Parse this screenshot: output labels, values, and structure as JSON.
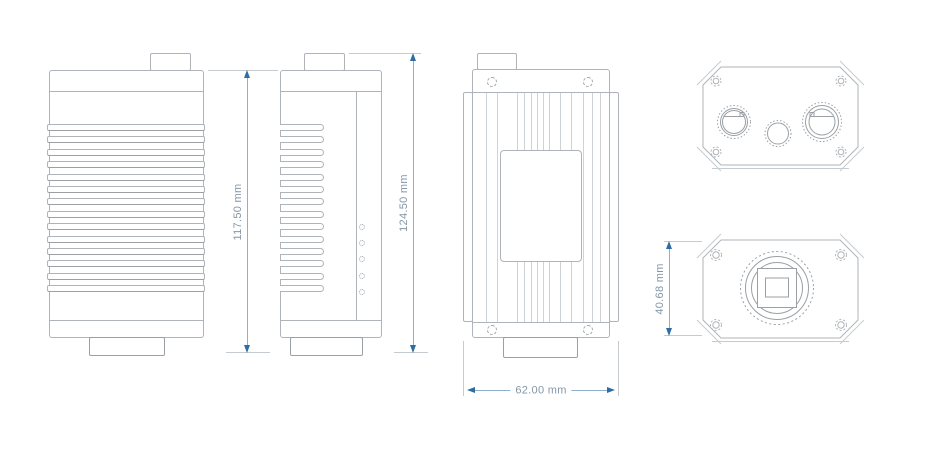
{
  "dimensions": {
    "body_height": "117.50 mm",
    "overall_height": "124.50 mm",
    "body_width": "62.00 mm",
    "face_height": "40.68 mm"
  },
  "colors": {
    "background": "#ffffff",
    "outline": "#aeb4b9",
    "outline_dark": "#9aa0a5",
    "rib": "#ced3d7",
    "dim_line": "#8fafcd",
    "dim_arrow": "#2e6da4",
    "dim_text": "#8496a7",
    "ext_line": "#c6cbcf"
  },
  "geometry": {
    "fin_count": 14,
    "led_count": 5,
    "rib_offsets": [
      14,
      25,
      45,
      52,
      59,
      65,
      71,
      77,
      88,
      99,
      111,
      120,
      128
    ]
  }
}
